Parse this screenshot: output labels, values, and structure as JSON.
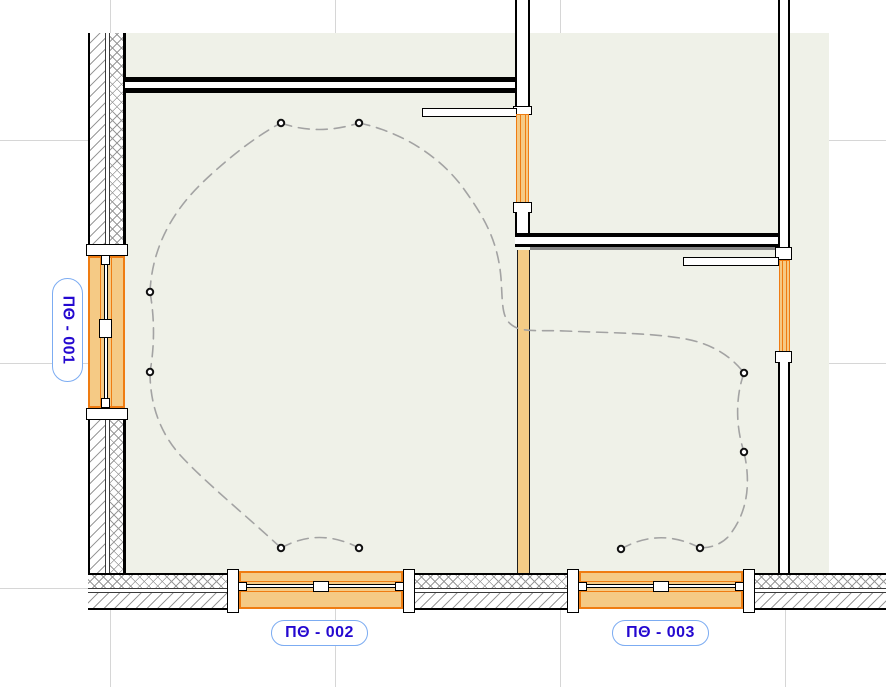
{
  "view": {
    "kind": "cad-electrical-floor-plan"
  },
  "labels": {
    "window1": "ПΘ - 001",
    "window2": "ПΘ - 002",
    "window3": "ПΘ - 003"
  },
  "colors": {
    "room_fill": "#eff1e8",
    "window_fill": "#f5ca85",
    "window_border": "#ef7c12",
    "wall_orange": "#f4cc86",
    "hatch_line": "#9a9a9a",
    "wire_color": "#a3a3a3",
    "grid_line": "#d6d6d6",
    "label_text": "#2408d0",
    "label_border": "#7cacf2"
  },
  "grid": {
    "vertical_x": [
      110,
      335,
      560,
      785
    ],
    "horizontal_y": [
      140,
      363,
      588
    ]
  },
  "wiring": {
    "paths": [
      "M281,123 Q318,136 359,123",
      "M150,292 Q157,332 150,372",
      "M150,292 C152,248 172,212 202,183 C227,159 256,136 281,123",
      "M359,123 C402,132 442,157 466,192 C486,220 498,243 501,278 C503,308 501,321 517,328 C527,332 545,330 565,331 C615,333 652,333 686,339 C712,344 731,356 744,373",
      "M744,373 C735,398 736,428 744,452",
      "M744,452 C751,483 748,513 728,537 C719,546 708,548 700,548",
      "M700,548 Q660,527 621,549",
      "M150,372 C150,403 159,432 181,456 C206,483 250,519 281,548",
      "M281,548 Q319,527 359,548"
    ],
    "fixtures": [
      [
        281,
        123
      ],
      [
        359,
        123
      ],
      [
        150,
        292
      ],
      [
        150,
        372
      ],
      [
        281,
        548
      ],
      [
        359,
        548
      ],
      [
        744,
        373
      ],
      [
        744,
        452
      ],
      [
        700,
        548
      ],
      [
        621,
        549
      ]
    ]
  }
}
